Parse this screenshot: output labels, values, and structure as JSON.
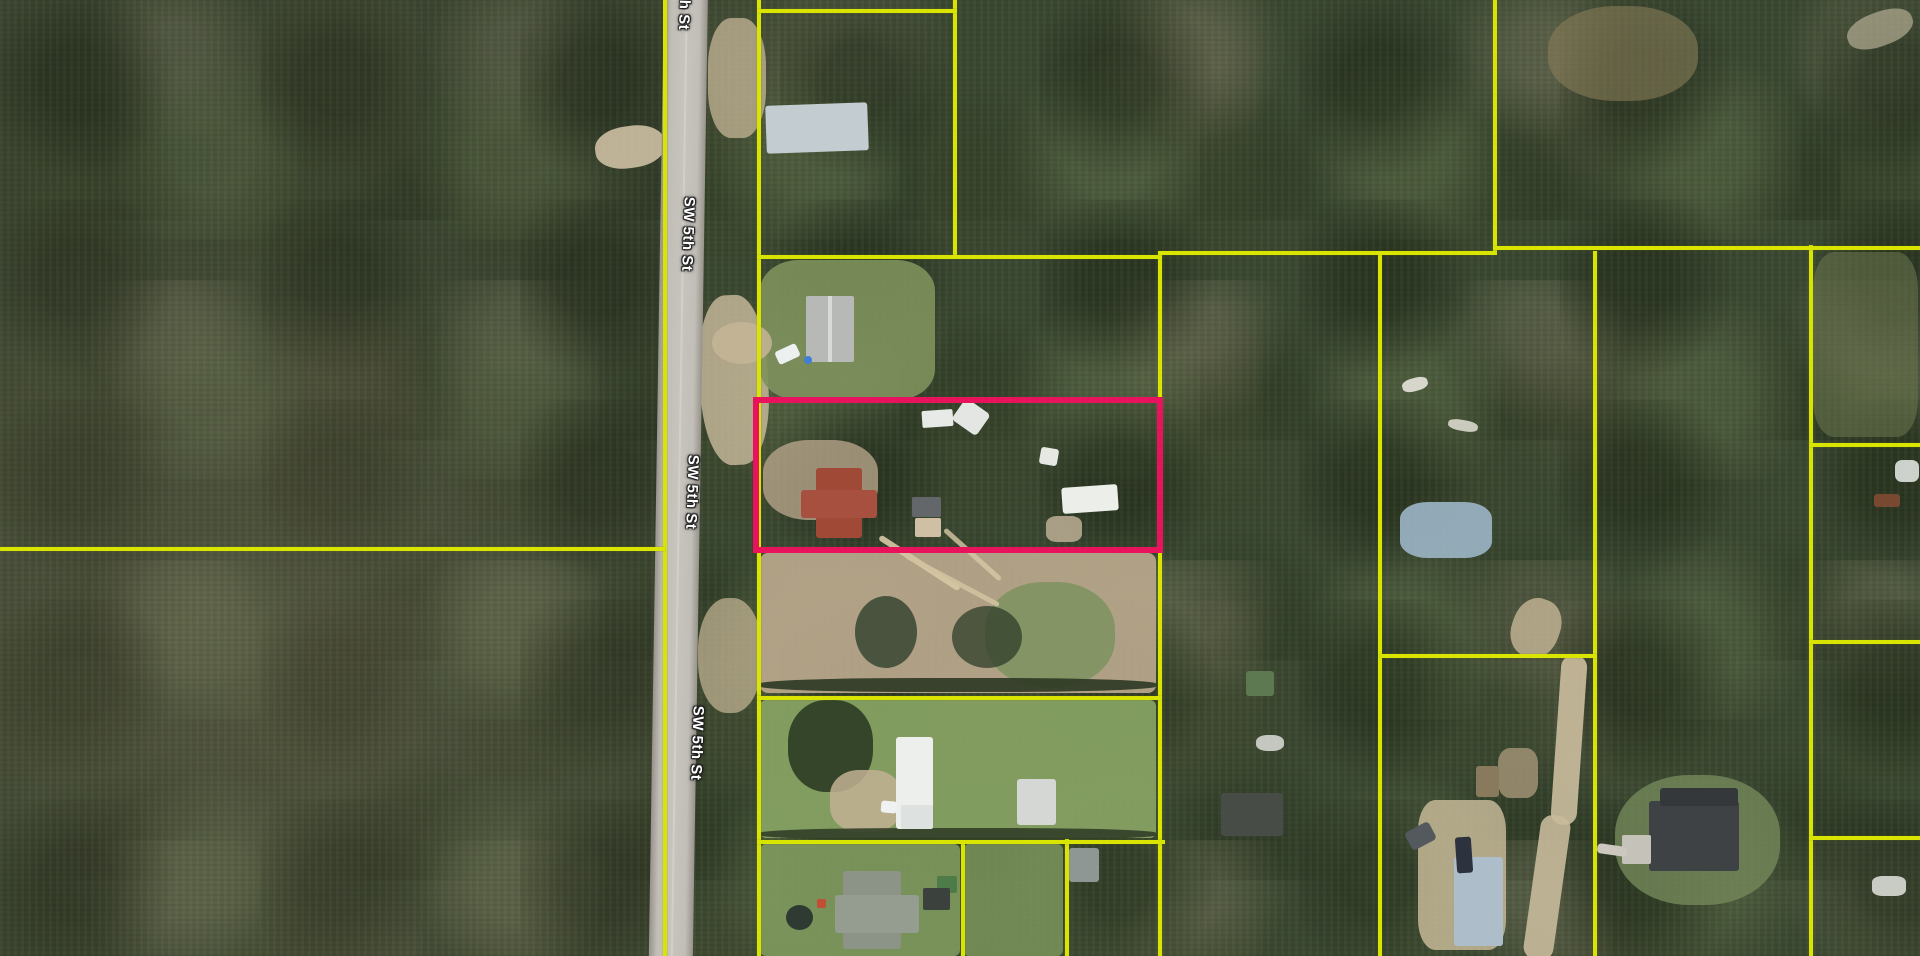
{
  "map": {
    "description": "aerial-parcel-map",
    "colors": {
      "parcel_boundary": "#d9e400",
      "selected_parcel": "#e8135c",
      "road_surface": "#c1beb7",
      "forest_base": "#3a4730"
    },
    "road": {
      "name": "SW 5th St",
      "x": 664,
      "y": -10,
      "width": 44,
      "height": 980,
      "lean_deg": 0.9,
      "labels": [
        {
          "text": "h St",
          "x": 684,
          "y": 15,
          "rot": 92
        },
        {
          "text": "SW 5th St",
          "x": 688,
          "y": 234,
          "rot": 92
        },
        {
          "text": "SW 5th St",
          "x": 692,
          "y": 492,
          "rot": 92
        },
        {
          "text": "SW 5th St",
          "x": 697,
          "y": 743,
          "rot": 92
        }
      ]
    },
    "selected_parcel": {
      "x": 753,
      "y": 397,
      "w": 410,
      "h": 156,
      "stroke": 6
    },
    "boundaries": {
      "vertical": [
        {
          "name": "west-road-line",
          "x": 663,
          "y": 0,
          "w": 4,
          "h": 956
        },
        {
          "name": "east-road-line",
          "x": 757,
          "y": 0,
          "w": 4,
          "h": 956
        },
        {
          "name": "top-parcel-right",
          "x": 953,
          "y": 0,
          "w": 4,
          "h": 258
        },
        {
          "name": "mid-col-1",
          "x": 1158,
          "y": 253,
          "w": 4,
          "h": 703
        },
        {
          "name": "mid-col-2",
          "x": 1378,
          "y": 253,
          "w": 4,
          "h": 703
        },
        {
          "name": "topright-left",
          "x": 1493,
          "y": 0,
          "w": 4,
          "h": 251
        },
        {
          "name": "right-col-1",
          "x": 1593,
          "y": 251,
          "w": 4,
          "h": 705
        },
        {
          "name": "right-col-2",
          "x": 1809,
          "y": 245,
          "w": 4,
          "h": 711
        },
        {
          "name": "bottom-v1",
          "x": 961,
          "y": 841,
          "w": 4,
          "h": 115
        },
        {
          "name": "bottom-v2",
          "x": 1065,
          "y": 839,
          "w": 4,
          "h": 117
        }
      ],
      "horizontal": [
        {
          "name": "west-cross-line",
          "x": 0,
          "y": 547,
          "w": 665,
          "h": 4
        },
        {
          "name": "top-parcel-top",
          "x": 757,
          "y": 9,
          "w": 200,
          "h": 4
        },
        {
          "name": "row-line-a",
          "x": 757,
          "y": 255,
          "w": 405,
          "h": 4
        },
        {
          "name": "row-line-b",
          "x": 1158,
          "y": 251,
          "w": 339,
          "h": 4
        },
        {
          "name": "row-line-c",
          "x": 1493,
          "y": 246,
          "w": 427,
          "h": 4
        },
        {
          "name": "fr-line-1",
          "x": 1809,
          "y": 443,
          "w": 111,
          "h": 4
        },
        {
          "name": "fr-line-2",
          "x": 1809,
          "y": 640,
          "w": 111,
          "h": 4
        },
        {
          "name": "col4-bottom",
          "x": 1380,
          "y": 654,
          "w": 217,
          "h": 4
        },
        {
          "name": "dirt-bottom",
          "x": 757,
          "y": 696,
          "w": 405,
          "h": 4
        },
        {
          "name": "lawn-bottom-line",
          "x": 757,
          "y": 840,
          "w": 408,
          "h": 4
        },
        {
          "name": "fr-line-3",
          "x": 1809,
          "y": 836,
          "w": 111,
          "h": 4
        }
      ]
    },
    "features": [
      {
        "name": "clearing-west",
        "x": 595,
        "y": 126,
        "w": 70,
        "h": 42,
        "c": "#cdbfa3",
        "o": 0.9,
        "rot": -8,
        "r": "45%",
        "z": 1
      },
      {
        "name": "shoulder-dirt-top",
        "x": 708,
        "y": 18,
        "w": 58,
        "h": 120,
        "c": "#c6b697",
        "o": 0.75,
        "rot": 0,
        "r": "40%",
        "z": 1
      },
      {
        "name": "shoulder-dirt-mid",
        "x": 700,
        "y": 295,
        "w": 68,
        "h": 170,
        "c": "#cbbb9d",
        "o": 0.8,
        "rot": -3,
        "r": "42%",
        "z": 1
      },
      {
        "name": "shoulder-dirt-low",
        "x": 698,
        "y": 598,
        "w": 64,
        "h": 115,
        "c": "#c8b897",
        "o": 0.7,
        "rot": 0,
        "r": "45%",
        "z": 1
      },
      {
        "name": "lawn-parcel2",
        "x": 760,
        "y": 260,
        "w": 175,
        "h": 140,
        "c": "#7e915c",
        "o": 0.9,
        "rot": 0,
        "r": "22%",
        "z": 1
      },
      {
        "name": "drive-parcel2",
        "x": 712,
        "y": 322,
        "w": 60,
        "h": 42,
        "c": "#c6b596",
        "o": 0.85,
        "rot": 0,
        "r": "50%",
        "z": 1
      },
      {
        "name": "dirt-selected",
        "x": 763,
        "y": 440,
        "w": 115,
        "h": 80,
        "c": "#b5a489",
        "o": 0.8,
        "rot": 0,
        "r": "40%",
        "z": 1
      },
      {
        "name": "dirt-field",
        "x": 760,
        "y": 553,
        "w": 396,
        "h": 140,
        "c": "#b6a58a",
        "o": 0.95,
        "rot": 0,
        "r": "8px",
        "z": 1
      },
      {
        "name": "grass-patch-dirt",
        "x": 985,
        "y": 582,
        "w": 130,
        "h": 105,
        "c": "#7d925f",
        "o": 0.85,
        "rot": 0,
        "r": "45%",
        "z": 1
      },
      {
        "name": "fallen-log-1",
        "x": 872,
        "y": 560,
        "w": 95,
        "h": 6,
        "c": "#d8c8a5",
        "o": 0.9,
        "rot": 33,
        "r": "3px",
        "z": 1
      },
      {
        "name": "fallen-log-2",
        "x": 900,
        "y": 578,
        "w": 105,
        "h": 5,
        "c": "#d2c29e",
        "o": 0.9,
        "rot": 28,
        "r": "3px",
        "z": 1
      },
      {
        "name": "fallen-log-3",
        "x": 935,
        "y": 552,
        "w": 75,
        "h": 5,
        "c": "#d8c8a5",
        "o": 0.8,
        "rot": 42,
        "r": "3px",
        "z": 1
      },
      {
        "name": "tree-shadow-dirt-1",
        "x": 855,
        "y": 596,
        "w": 62,
        "h": 72,
        "c": "#30402b",
        "o": 0.8,
        "rot": 0,
        "r": "50%",
        "z": 1
      },
      {
        "name": "tree-shadow-dirt-2",
        "x": 952,
        "y": 606,
        "w": 70,
        "h": 62,
        "c": "#2f3e2a",
        "o": 0.75,
        "rot": 0,
        "r": "50%",
        "z": 1
      },
      {
        "name": "hedge-dirt-bottom",
        "x": 760,
        "y": 678,
        "w": 396,
        "h": 14,
        "c": "#2c3722",
        "o": 0.9,
        "rot": 0,
        "r": "40%",
        "z": 1
      },
      {
        "name": "lawn-greenhouse",
        "x": 760,
        "y": 700,
        "w": 396,
        "h": 138,
        "c": "#86a162",
        "o": 0.95,
        "rot": 0,
        "r": "6px",
        "z": 1
      },
      {
        "name": "oak-canopy",
        "x": 788,
        "y": 700,
        "w": 85,
        "h": 92,
        "c": "#2f4027",
        "o": 0.95,
        "rot": 0,
        "r": "45%",
        "z": 1
      },
      {
        "name": "drive-greenhouse",
        "x": 830,
        "y": 770,
        "w": 72,
        "h": 62,
        "c": "#c3b294",
        "o": 0.85,
        "rot": 0,
        "r": "40%",
        "z": 1
      },
      {
        "name": "hedge-gh-bottom",
        "x": 760,
        "y": 828,
        "w": 396,
        "h": 12,
        "c": "#313e27",
        "o": 0.9,
        "rot": 0,
        "r": "40%",
        "z": 1
      },
      {
        "name": "lawn-bottom-left",
        "x": 760,
        "y": 844,
        "w": 200,
        "h": 112,
        "c": "#7f9a5e",
        "o": 0.9,
        "rot": 0,
        "r": "6px",
        "z": 1
      },
      {
        "name": "lawn-bottom-mid",
        "x": 963,
        "y": 844,
        "w": 100,
        "h": 112,
        "c": "#7a945a",
        "o": 0.85,
        "rot": 0,
        "r": "6px",
        "z": 1
      },
      {
        "name": "clearing-charcoal",
        "x": 1615,
        "y": 775,
        "w": 165,
        "h": 130,
        "c": "#74885a",
        "o": 0.8,
        "rot": 0,
        "r": "45%",
        "z": 1
      },
      {
        "name": "dirt-road-right-a",
        "x": 1556,
        "y": 655,
        "w": 26,
        "h": 170,
        "c": "#ccbe9f",
        "o": 0.9,
        "rot": 4,
        "r": "12px",
        "z": 1
      },
      {
        "name": "dirt-road-right-b",
        "x": 1532,
        "y": 815,
        "w": 30,
        "h": 145,
        "c": "#c8ba9b",
        "o": 0.9,
        "rot": 8,
        "r": "12px",
        "z": 1
      },
      {
        "name": "dirt-right-lot",
        "x": 1418,
        "y": 800,
        "w": 88,
        "h": 150,
        "c": "#c6b898",
        "o": 0.85,
        "rot": 0,
        "r": "20%",
        "z": 1
      },
      {
        "name": "dirt-path-col4",
        "x": 1512,
        "y": 598,
        "w": 48,
        "h": 60,
        "c": "#c5b796",
        "o": 0.8,
        "rot": 20,
        "r": "45%",
        "z": 1
      },
      {
        "name": "blue-tarp",
        "x": 1400,
        "y": 502,
        "w": 92,
        "h": 56,
        "c": "#9cb6c6",
        "o": 0.9,
        "rot": 0,
        "r": "30%",
        "z": 1
      },
      {
        "name": "dead-field-topright",
        "x": 1548,
        "y": 6,
        "w": 150,
        "h": 95,
        "c": "#877d58",
        "o": 0.6,
        "rot": 0,
        "r": "45%",
        "z": 1
      },
      {
        "name": "dry-field-right",
        "x": 1813,
        "y": 252,
        "w": 105,
        "h": 185,
        "c": "#6e7950",
        "o": 0.55,
        "rot": 0,
        "r": "20%",
        "z": 1
      },
      {
        "name": "debris-pile",
        "x": 1498,
        "y": 748,
        "w": 40,
        "h": 50,
        "c": "#9a8d70",
        "o": 0.9,
        "rot": 0,
        "r": "30%",
        "z": 1
      },
      {
        "name": "white-scatter-1",
        "x": 1402,
        "y": 378,
        "w": 26,
        "h": 13,
        "c": "#e6e4da",
        "o": 0.9,
        "rot": -15,
        "r": "40%",
        "z": 1
      },
      {
        "name": "white-scatter-2",
        "x": 1448,
        "y": 420,
        "w": 30,
        "h": 11,
        "c": "#e2e0d6",
        "o": 0.85,
        "rot": 10,
        "r": "40%",
        "z": 1
      },
      {
        "name": "white-tarp-right",
        "x": 1895,
        "y": 460,
        "w": 24,
        "h": 22,
        "c": "#dfe2df",
        "o": 0.9,
        "rot": 0,
        "r": "30%",
        "z": 1
      },
      {
        "name": "rust-vehicles",
        "x": 1874,
        "y": 494,
        "w": 26,
        "h": 13,
        "c": "#7c4a32",
        "o": 0.95,
        "rot": 0,
        "r": "3px",
        "z": 1
      },
      {
        "name": "white-debris-br",
        "x": 1872,
        "y": 876,
        "w": 34,
        "h": 20,
        "c": "#d8dbd5",
        "o": 0.9,
        "rot": 0,
        "r": "30%",
        "z": 1
      },
      {
        "name": "dead-grass-tr",
        "x": 1846,
        "y": 12,
        "w": 68,
        "h": 34,
        "c": "#b3ac93",
        "o": 0.7,
        "rot": -20,
        "r": "45%",
        "z": 1
      },
      {
        "name": "white-debris-mid",
        "x": 1256,
        "y": 735,
        "w": 28,
        "h": 16,
        "c": "#dcded8",
        "o": 0.85,
        "rot": 0,
        "r": "40%",
        "z": 1
      },
      {
        "name": "roof-house-top",
        "x": 766,
        "y": 104,
        "w": 102,
        "h": 48,
        "c": "#c2ccd1",
        "o": 1,
        "rot": -2,
        "r": "3px",
        "z": 3
      },
      {
        "name": "roof-house2",
        "x": 806,
        "y": 296,
        "w": 48,
        "h": 66,
        "c": "#b6b9b6",
        "o": 1,
        "rot": 0,
        "r": "2px",
        "z": 3
      },
      {
        "name": "roof-house2-ridge",
        "x": 828,
        "y": 296,
        "w": 4,
        "h": 66,
        "c": "#d8dad8",
        "o": 1,
        "rot": 0,
        "r": "0",
        "z": 3
      },
      {
        "name": "car-white-p2",
        "x": 776,
        "y": 347,
        "w": 23,
        "h": 14,
        "c": "#edf0f1",
        "o": 1,
        "rot": -25,
        "r": "3px",
        "z": 3
      },
      {
        "name": "barrel-blue",
        "x": 804,
        "y": 356,
        "w": 8,
        "h": 8,
        "c": "#3f7fd6",
        "o": 1,
        "rot": 0,
        "r": "50%",
        "z": 3
      },
      {
        "name": "roof-red-main",
        "x": 816,
        "y": 468,
        "w": 46,
        "h": 70,
        "c": "#a04936",
        "o": 1,
        "rot": 0,
        "r": "3px",
        "z": 3
      },
      {
        "name": "roof-red-wing",
        "x": 801,
        "y": 490,
        "w": 76,
        "h": 28,
        "c": "#a85040",
        "o": 1,
        "rot": 0,
        "r": "3px",
        "z": 3
      },
      {
        "name": "shed-gray-selected",
        "x": 912,
        "y": 497,
        "w": 29,
        "h": 20,
        "c": "#63676a",
        "o": 1,
        "rot": 0,
        "r": "2px",
        "z": 3
      },
      {
        "name": "pad-tan",
        "x": 915,
        "y": 518,
        "w": 26,
        "h": 19,
        "c": "#cfc0a3",
        "o": 1,
        "rot": 0,
        "r": "2px",
        "z": 3
      },
      {
        "name": "trailer-white",
        "x": 922,
        "y": 410,
        "w": 31,
        "h": 17,
        "c": "#e8eae7",
        "o": 1,
        "rot": -4,
        "r": "2px",
        "z": 3
      },
      {
        "name": "boat-white",
        "x": 956,
        "y": 404,
        "w": 30,
        "h": 26,
        "c": "#e4e6e3",
        "o": 1,
        "rot": 35,
        "r": "4px",
        "z": 3
      },
      {
        "name": "mobile-home-white",
        "x": 1062,
        "y": 486,
        "w": 56,
        "h": 26,
        "c": "#ebeee9",
        "o": 1,
        "rot": -4,
        "r": "3px",
        "z": 3
      },
      {
        "name": "white-bit",
        "x": 1040,
        "y": 448,
        "w": 18,
        "h": 17,
        "c": "#e6e8e4",
        "o": 1,
        "rot": 10,
        "r": "3px",
        "z": 3
      },
      {
        "name": "debris-tan",
        "x": 1046,
        "y": 516,
        "w": 36,
        "h": 26,
        "c": "#b5a98f",
        "o": 0.9,
        "rot": 0,
        "r": "30%",
        "z": 3
      },
      {
        "name": "greenhouse-building",
        "x": 896,
        "y": 737,
        "w": 37,
        "h": 92,
        "c": "#edefec",
        "o": 1,
        "rot": 0,
        "r": "3px",
        "z": 3
      },
      {
        "name": "greenhouse-canopy",
        "x": 901,
        "y": 805,
        "w": 32,
        "h": 24,
        "c": "#dde1e0",
        "o": 1,
        "rot": 0,
        "r": "2px",
        "z": 3
      },
      {
        "name": "car-white-gh",
        "x": 881,
        "y": 801,
        "w": 16,
        "h": 12,
        "c": "#f0f2f1",
        "o": 1,
        "rot": 5,
        "r": "3px",
        "z": 3
      },
      {
        "name": "shed2-greenhouse",
        "x": 1017,
        "y": 779,
        "w": 39,
        "h": 46,
        "c": "#d4d7d4",
        "o": 1,
        "rot": 0,
        "r": "3px",
        "z": 3
      },
      {
        "name": "house-bottom-main",
        "x": 843,
        "y": 871,
        "w": 58,
        "h": 78,
        "c": "#8b9487",
        "o": 1,
        "rot": 0,
        "r": "3px",
        "z": 3
      },
      {
        "name": "house-bottom-wing",
        "x": 835,
        "y": 895,
        "w": 84,
        "h": 38,
        "c": "#949d90",
        "o": 1,
        "rot": 0,
        "r": "3px",
        "z": 3
      },
      {
        "name": "trampoline",
        "x": 786,
        "y": 905,
        "w": 27,
        "h": 25,
        "c": "#2e3a32",
        "o": 1,
        "rot": 0,
        "r": "50%",
        "z": 3
      },
      {
        "name": "toy-red",
        "x": 817,
        "y": 899,
        "w": 9,
        "h": 9,
        "c": "#c14f36",
        "o": 1,
        "rot": 0,
        "r": "2px",
        "z": 3
      },
      {
        "name": "shed-green",
        "x": 937,
        "y": 876,
        "w": 20,
        "h": 17,
        "c": "#4d7c49",
        "o": 1,
        "rot": 0,
        "r": "2px",
        "z": 3
      },
      {
        "name": "shed-dark",
        "x": 923,
        "y": 888,
        "w": 27,
        "h": 22,
        "c": "#3b423e",
        "o": 1,
        "rot": 0,
        "r": "2px",
        "z": 3
      },
      {
        "name": "house-gray-small",
        "x": 1069,
        "y": 848,
        "w": 30,
        "h": 34,
        "c": "#8e9793",
        "o": 1,
        "rot": 0,
        "r": "3px",
        "z": 3
      },
      {
        "name": "shed-green-mid",
        "x": 1246,
        "y": 671,
        "w": 28,
        "h": 25,
        "c": "#5c7951",
        "o": 1,
        "rot": 0,
        "r": "3px",
        "z": 3
      },
      {
        "name": "house-dark-mid",
        "x": 1221,
        "y": 793,
        "w": 62,
        "h": 43,
        "c": "#474c47",
        "o": 1,
        "rot": 0,
        "r": "3px",
        "z": 3
      },
      {
        "name": "roof-paleblue-big",
        "x": 1454,
        "y": 857,
        "w": 49,
        "h": 89,
        "c": "#adbeca",
        "o": 1,
        "rot": 0,
        "r": "3px",
        "z": 3
      },
      {
        "name": "truck-dark",
        "x": 1456,
        "y": 837,
        "w": 16,
        "h": 36,
        "c": "#2c333f",
        "o": 1,
        "rot": -4,
        "r": "3px",
        "z": 3
      },
      {
        "name": "car-dark",
        "x": 1407,
        "y": 826,
        "w": 27,
        "h": 20,
        "c": "#54595d",
        "o": 1,
        "rot": -28,
        "r": "4px",
        "z": 3
      },
      {
        "name": "shed-brown",
        "x": 1476,
        "y": 766,
        "w": 23,
        "h": 31,
        "c": "#897a5d",
        "o": 1,
        "rot": 0,
        "r": "3px",
        "z": 3
      },
      {
        "name": "house-charcoal-main",
        "x": 1649,
        "y": 801,
        "w": 90,
        "h": 70,
        "c": "#3e4244",
        "o": 1,
        "rot": 0,
        "r": "3px",
        "z": 3
      },
      {
        "name": "house-charcoal-wing",
        "x": 1660,
        "y": 788,
        "w": 78,
        "h": 18,
        "c": "#34383a",
        "o": 1,
        "rot": 0,
        "r": "3px",
        "z": 3
      },
      {
        "name": "driveway-pad",
        "x": 1622,
        "y": 835,
        "w": 29,
        "h": 29,
        "c": "#c5c2b9",
        "o": 1,
        "rot": 0,
        "r": "2px",
        "z": 3
      },
      {
        "name": "path-charcoal",
        "x": 1597,
        "y": 845,
        "w": 30,
        "h": 10,
        "c": "#ccc8bf",
        "o": 1,
        "rot": 8,
        "r": "4px",
        "z": 3
      }
    ]
  }
}
